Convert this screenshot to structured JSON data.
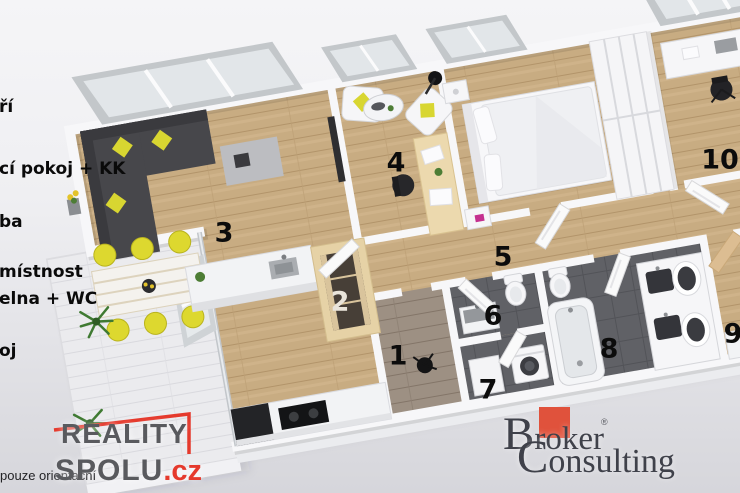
{
  "watermark": "pouze orientační",
  "legend": {
    "items": [
      {
        "text": "ří"
      },
      {
        "text": "cí pokoj + KK"
      },
      {
        "text": "ba"
      },
      {
        "text": "místnost"
      },
      {
        "text": "elna + WC"
      },
      {
        "text": "oj"
      }
    ]
  },
  "rooms": [
    {
      "number": "1"
    },
    {
      "number": "2"
    },
    {
      "number": "3"
    },
    {
      "number": "4"
    },
    {
      "number": "5"
    },
    {
      "number": "6"
    },
    {
      "number": "7"
    },
    {
      "number": "8"
    },
    {
      "number": "9"
    },
    {
      "number": "10"
    }
  ],
  "logos": {
    "reality_spolu": {
      "word1": "REALITY",
      "word2": "SPOLU",
      "tld": ".cz"
    },
    "broker": {
      "word1": "Broker",
      "registered": "®",
      "word2": "Consulting"
    }
  },
  "colors": {
    "reality_red": "#e5392c",
    "reality_gray": "#595a5e",
    "broker_red": "#e0523c",
    "broker_gray": "#3f414a",
    "floor_wood": "#c8ac82",
    "floor_wood_dark": "#9d8e7c",
    "floor_tile": "#606166",
    "terrace_deck": "#ebebee",
    "wall_white": "#f7f7f9",
    "sofa_dark": "#47474b",
    "accent_yellow": "#d8d631",
    "accent_magenta": "#c4308f"
  }
}
